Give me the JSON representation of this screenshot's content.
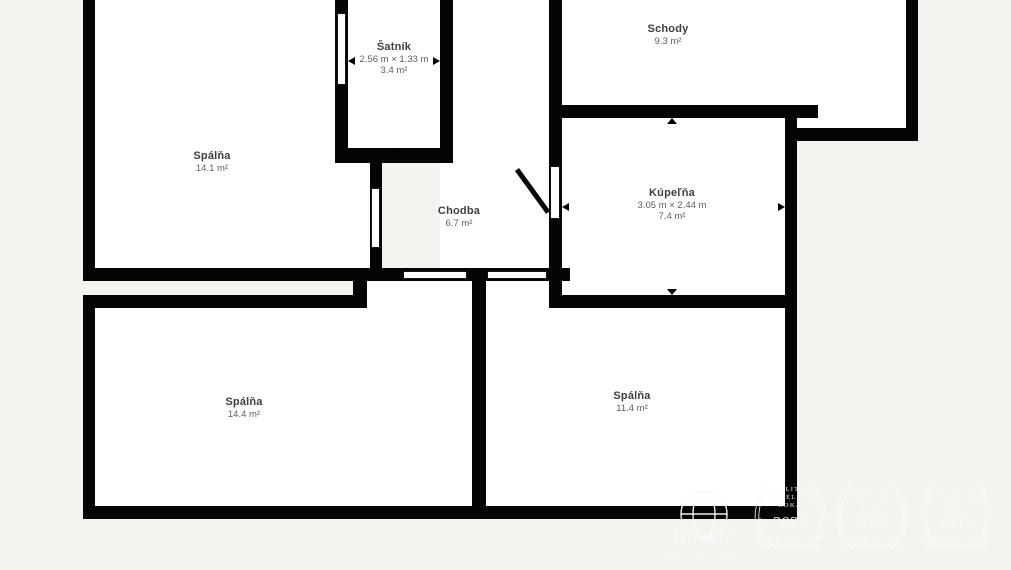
{
  "colors": {
    "background": "#f4f3f0",
    "wall": "#050505",
    "room_fill": "#ffffff",
    "label_text": "#3e3e3e",
    "dim_text": "#5d5d5d",
    "watermark": "#faf9f7"
  },
  "rooms": [
    {
      "id": "spalna-top-left",
      "name": "Spálňa",
      "area": "14.1 m²"
    },
    {
      "id": "satnik",
      "name": "Šatník",
      "dimensions": "2.56 m × 1.33 m",
      "area": "3.4 m²"
    },
    {
      "id": "schody",
      "name": "Schody",
      "area": "9.3 m²"
    },
    {
      "id": "chodba",
      "name": "Chodba",
      "area": "6.7 m²"
    },
    {
      "id": "kupelna",
      "name": "Kúpeľňa",
      "dimensions": "3.05 m × 2.44 m",
      "area": "7.4 m²"
    },
    {
      "id": "spalna-bottom-left",
      "name": "Spálňa",
      "area": "14.4 m²"
    },
    {
      "id": "spalna-bottom-right",
      "name": "Spálňa",
      "area": "11.4 m²"
    }
  ],
  "watermark": {
    "brand": "Bosen",
    "registered_mark": "®",
    "brand_subtitle": "REAL ESTATE",
    "badges": [
      {
        "line1": "REALITNÁ",
        "line2": "KANCELÁRIA",
        "line3": "ROKA",
        "year": "2023",
        "subtitle": "BRATISLAVSKÝ KRAJ"
      },
      {
        "line1": "REALITNÁ",
        "line2": "KANCELÁRIA",
        "line3": "ROKA",
        "year": "2020",
        "subtitle": "ABSOLÚTNY VÍŤAZ"
      },
      {
        "line1": "REALITNÁ",
        "line2": "KANCELÁRIA",
        "line3": "ROKA",
        "year": "2019",
        "subtitle": "ABSOLÚTNY VÍŤAZ"
      }
    ]
  }
}
